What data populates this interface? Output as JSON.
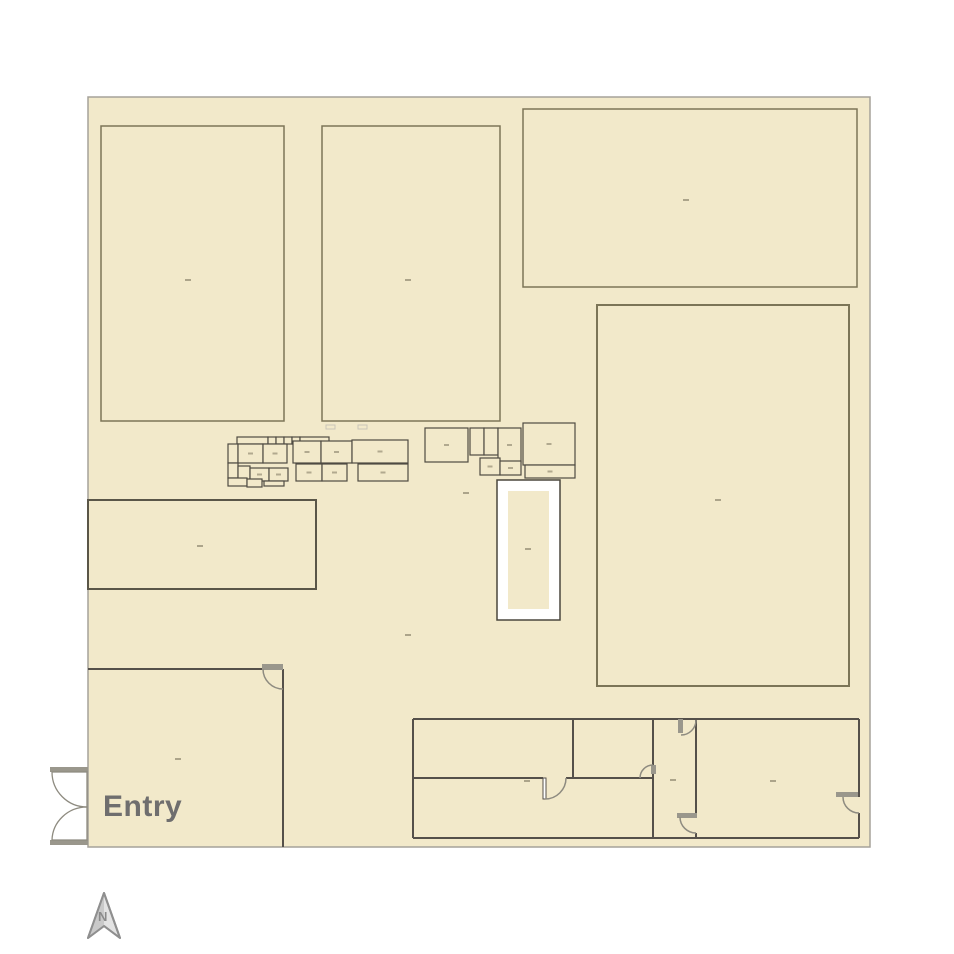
{
  "labels": {
    "entry": "Entry",
    "compass_north": "N"
  },
  "colors": {
    "page_bg": "#ffffff",
    "plan_fill": "#f2e9ca",
    "boundary_stroke": "#a5a29a",
    "room_border_olive": "#7c7557",
    "room_border_dark": "#5a5648",
    "wall": "#55504a",
    "cluster_stroke": "#4f4b43",
    "door_gray": "#9a978c",
    "arc_stroke": "#8e8b80",
    "label_dash": "#a0987f",
    "faint_mark": "#c9c5b8",
    "entry_text": "#6f6e6e",
    "white_rect_fill": "#ffffff",
    "white_rect_stroke": "#4a473d",
    "north_fill_light": "#e3e3e3",
    "north_fill_dark": "#c9c9c9",
    "north_stroke": "#8f8f8f",
    "north_text": "#8a8a8a"
  },
  "floorplan": {
    "boundary": {
      "x": 88,
      "y": 97,
      "w": 782,
      "h": 750
    },
    "rooms": [
      {
        "x": 101,
        "y": 126,
        "w": 183,
        "h": 295,
        "s": "room_border_olive",
        "sw": 1.5
      },
      {
        "x": 322,
        "y": 126,
        "w": 178,
        "h": 295,
        "s": "room_border_olive",
        "sw": 1.5
      },
      {
        "x": 523,
        "y": 109,
        "w": 334,
        "h": 178,
        "s": "room_border_olive",
        "sw": 1.5
      },
      {
        "x": 597,
        "y": 305,
        "w": 252,
        "h": 381,
        "s": "room_border_olive",
        "sw": 2
      },
      {
        "x": 88,
        "y": 500,
        "w": 228,
        "h": 89,
        "s": "room_border_dark",
        "sw": 2
      }
    ],
    "white_rect": {
      "outer": [
        497,
        480,
        63,
        140
      ],
      "inner": [
        508,
        491,
        41,
        118
      ]
    },
    "walls": [
      [
        88,
        669,
        262,
        669
      ],
      [
        283,
        669,
        283,
        847
      ],
      [
        413,
        719,
        859,
        719
      ],
      [
        413,
        719,
        413,
        838
      ],
      [
        413,
        838,
        859,
        838
      ],
      [
        413,
        778,
        543,
        778
      ],
      [
        566,
        778,
        653,
        778
      ],
      [
        573,
        719,
        573,
        778
      ],
      [
        653,
        719,
        653,
        838
      ],
      [
        696,
        719,
        696,
        817
      ],
      [
        696,
        833,
        696,
        838
      ],
      [
        859,
        719,
        859,
        797
      ],
      [
        859,
        813,
        859,
        838
      ]
    ],
    "door_leaf_rects": [
      {
        "x": 543,
        "y": 778,
        "w": 3,
        "h": 21
      }
    ],
    "gray_rects": [
      [
        262,
        664,
        21,
        6
      ],
      [
        678,
        719,
        5,
        14
      ],
      [
        677,
        813,
        20,
        5
      ],
      [
        651,
        765,
        5,
        9
      ],
      [
        836,
        792,
        22,
        5
      ],
      [
        50,
        767,
        38,
        5
      ],
      [
        50,
        840,
        38,
        5
      ]
    ],
    "arcs": [
      "M 263 669 A 20 20 0 0 0 283 689",
      "M 545 799 A 21 21 0 0 0 566 778",
      "M 640 778 A 13 13 0 0 1 653 765",
      "M 696 720 A 15 15 0 0 1 681 735",
      "M 680 817 A 16 16 0 0 0 696 833",
      "M 843 797 A 16 16 0 0 0 859 813"
    ],
    "door_leaves": [
      "M 52 772 A 35 35 0 0 0 87 807 L 87 772 Z",
      "M 52 840 A 35 34 0 0 1 87 807 L 87 840 Z"
    ],
    "cluster_boxes": [
      [
        237,
        437,
        31,
        7
      ],
      [
        268,
        437,
        8,
        7
      ],
      [
        276,
        437,
        8,
        7
      ],
      [
        284,
        437,
        8,
        7
      ],
      [
        292,
        437,
        8,
        7
      ],
      [
        300,
        437,
        29,
        7
      ],
      [
        228,
        444,
        10,
        19
      ],
      [
        238,
        444,
        25,
        19
      ],
      [
        263,
        444,
        24,
        19
      ],
      [
        293,
        441,
        28,
        22
      ],
      [
        321,
        441,
        31,
        22
      ],
      [
        352,
        440,
        56,
        23
      ],
      [
        228,
        463,
        10,
        15
      ],
      [
        238,
        466,
        12,
        19
      ],
      [
        250,
        468,
        19,
        13
      ],
      [
        269,
        468,
        19,
        13
      ],
      [
        296,
        464,
        26,
        17
      ],
      [
        322,
        464,
        25,
        17
      ],
      [
        358,
        464,
        50,
        17
      ],
      [
        228,
        478,
        19,
        8
      ],
      [
        247,
        479,
        15,
        8
      ],
      [
        264,
        481,
        20,
        5
      ],
      [
        425,
        428,
        43,
        34
      ],
      [
        470,
        428,
        14,
        27
      ],
      [
        484,
        428,
        14,
        27
      ],
      [
        498,
        428,
        23,
        34
      ],
      [
        523,
        423,
        52,
        42
      ],
      [
        480,
        458,
        20,
        17
      ],
      [
        500,
        461,
        21,
        14
      ],
      [
        525,
        465,
        50,
        13
      ]
    ],
    "tiny_labels": [
      [
        188,
        280
      ],
      [
        408,
        280
      ],
      [
        686,
        200
      ],
      [
        718,
        500
      ],
      [
        200,
        546
      ],
      [
        528,
        549
      ],
      [
        178,
        759
      ],
      [
        408,
        635
      ],
      [
        466,
        493
      ],
      [
        527,
        781
      ],
      [
        673,
        780
      ],
      [
        773,
        781
      ]
    ],
    "faint_marks": [
      [
        330,
        427
      ],
      [
        362,
        427
      ]
    ]
  }
}
